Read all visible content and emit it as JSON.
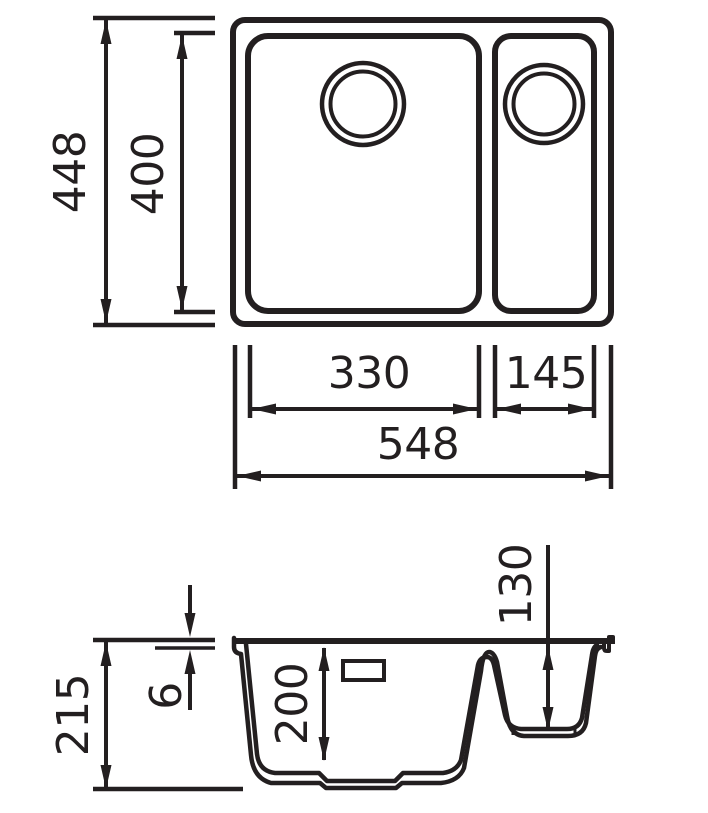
{
  "colors": {
    "line": "#231f20",
    "background": "#ffffff"
  },
  "views": {
    "top": {
      "dims": {
        "overall_height": "448",
        "bowl_height": "400",
        "main_bowl_width": "330",
        "small_bowl_width": "145",
        "overall_width": "548"
      }
    },
    "section": {
      "dims": {
        "overall_depth": "215",
        "rim_thickness": "6",
        "main_bowl_depth": "200",
        "small_bowl_depth": "130"
      }
    }
  }
}
